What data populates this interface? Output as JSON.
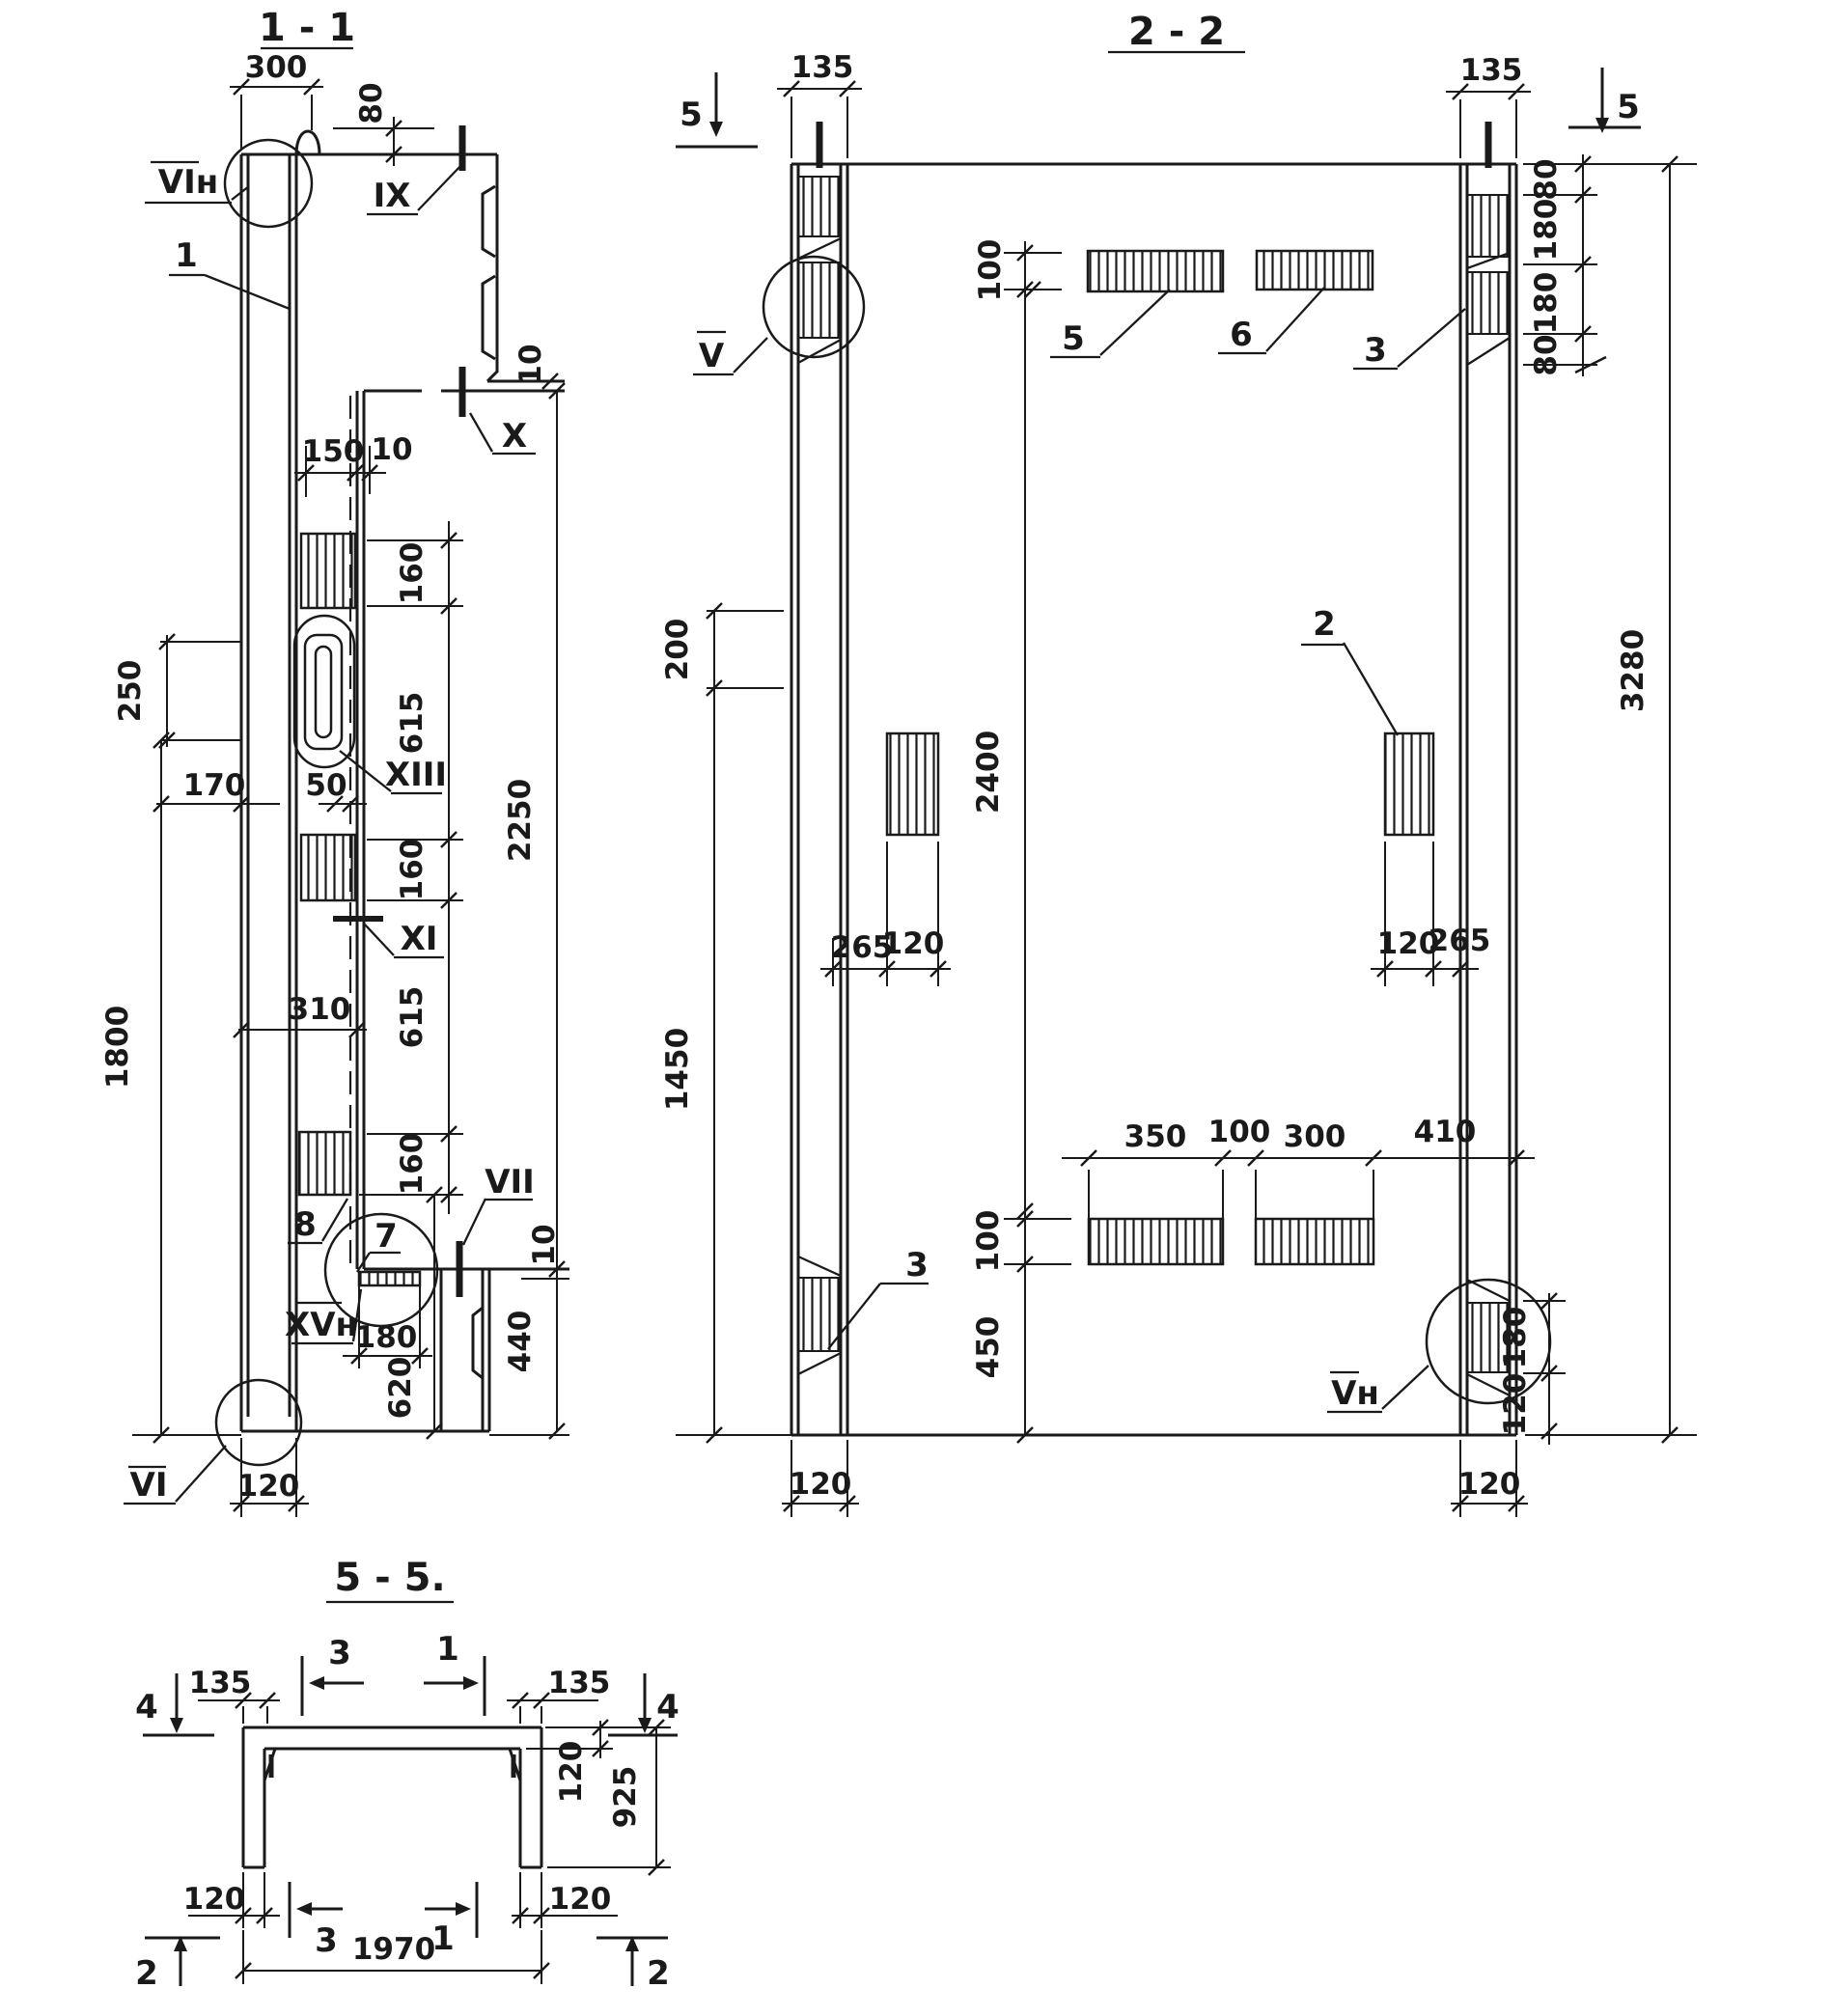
{
  "meta": {
    "background": "#ffffff",
    "ink": "#1a1a1a",
    "drawing_type": "structural precast panel sections"
  },
  "s11": {
    "title": "1 - 1",
    "labels": {
      "vi_top": "VIн",
      "ix": "IX",
      "pos1": "1",
      "x": "X",
      "xiii": "XIII",
      "xi": "XI",
      "pos8": "8",
      "pos7": "7",
      "vii": "VII",
      "xv": "XVн",
      "vi_bottom": "VI"
    },
    "dims": {
      "w300": "300",
      "h80": "80",
      "o10a": "10",
      "w150": "150",
      "w10": "10",
      "s160a": "160",
      "s615a": "615",
      "v250": "250",
      "w170": "170",
      "w50": "50",
      "s160b": "160",
      "s615b": "615",
      "v2250": "2250",
      "v1800": "1800",
      "s160c": "160",
      "w310": "310",
      "o10b": "10",
      "w180": "180",
      "v440": "440",
      "v620": "620",
      "w120": "120"
    }
  },
  "s22": {
    "title": "2 - 2",
    "labels": {
      "cut5_left": "5",
      "cut5_right": "5",
      "v": "V",
      "p5": "5",
      "p6": "6",
      "p3_top": "3",
      "p2": "2",
      "p3_bottom": "3",
      "vn": "Vн"
    },
    "dims": {
      "w135l": "135",
      "w135r": "135",
      "h100top": "100",
      "r80a": "80",
      "r180a": "180",
      "r180b": "180",
      "r80b": "80",
      "v3280": "3280",
      "v200": "200",
      "v2400": "2400",
      "w265l": "265",
      "w120l": "120",
      "w120r": "120",
      "w265r": "265",
      "v1450": "1450",
      "c350": "350",
      "c100": "100",
      "c300": "300",
      "c410": "410",
      "h100low": "100",
      "v450": "450",
      "r180low": "180",
      "r120low": "120",
      "b120l": "120",
      "b120r": "120"
    }
  },
  "s55": {
    "title": "5 - 5.",
    "labels": {
      "cut4_left": "4",
      "cut3_top": "3",
      "cut1_top": "1",
      "cut4_right": "4",
      "cut3_bottom": "3",
      "cut1_bottom": "1",
      "cut2_left": "2",
      "cut2_right": "2"
    },
    "dims": {
      "w135l": "135",
      "w135r": "135",
      "t120": "120",
      "h925": "925",
      "leg120l": "120",
      "leg120r": "120",
      "w1970": "1970"
    }
  }
}
